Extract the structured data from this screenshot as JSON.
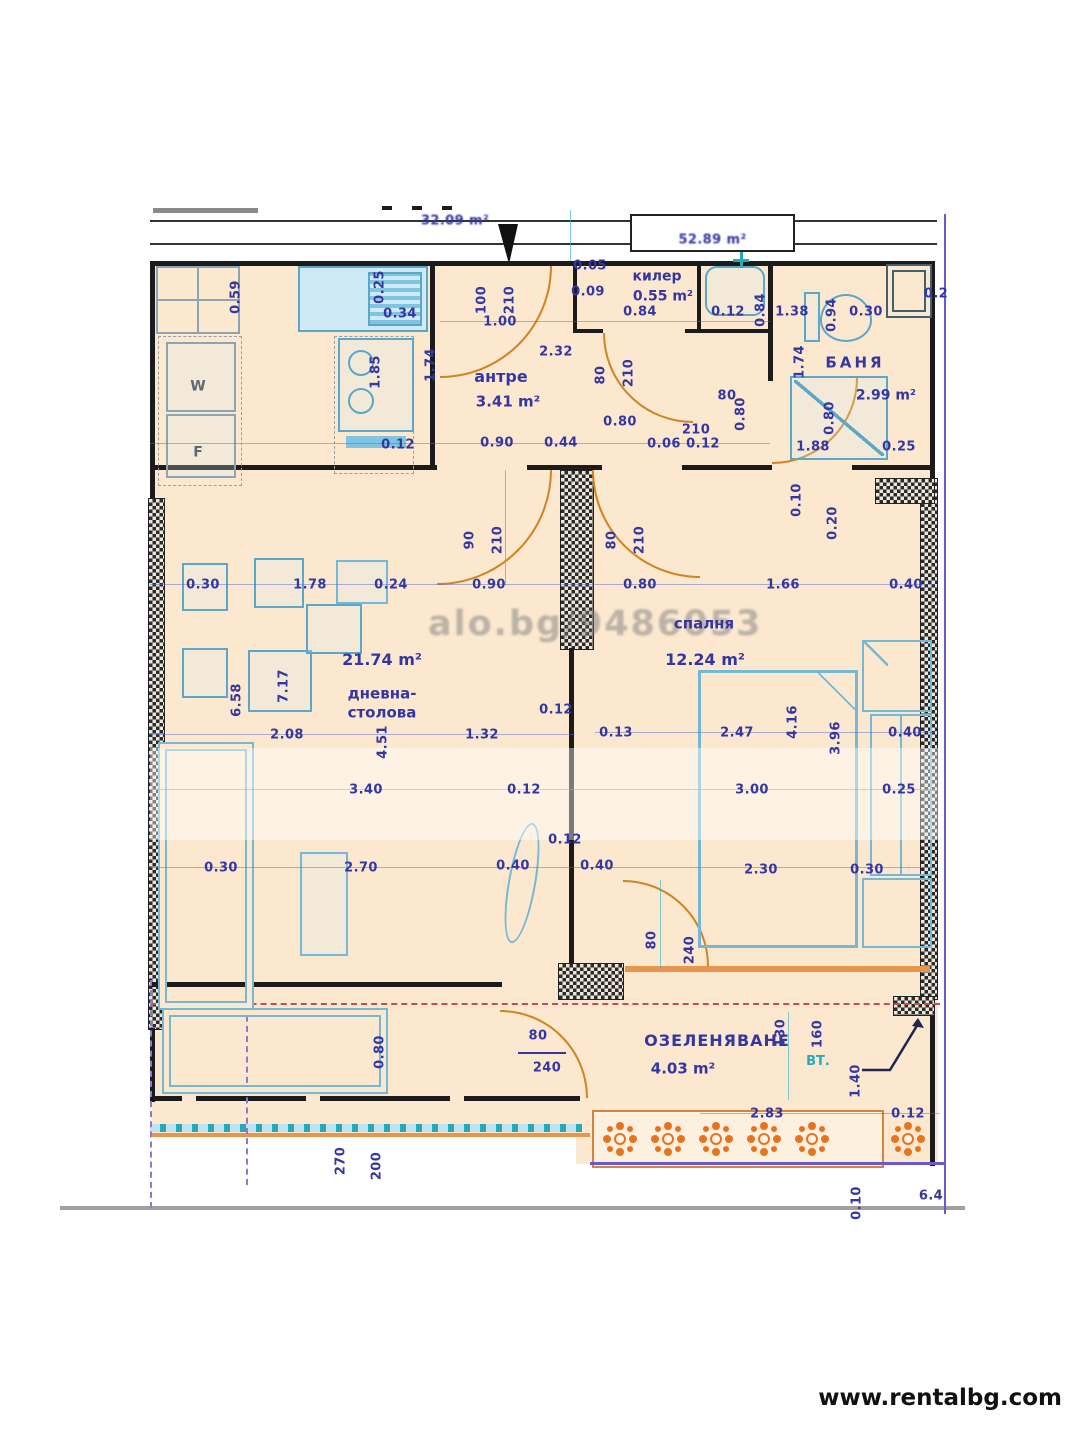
{
  "site": {
    "url": "www.rentalbg.com"
  },
  "watermarks": {
    "photo_id": "alo.bg/9486053"
  },
  "header": {
    "left_area": "32.09 m²",
    "box_area": "52.89 m²"
  },
  "rooms": [
    {
      "name": "антре",
      "area": "3.41 m²",
      "name_pos": [
        501,
        377
      ],
      "area_pos": [
        508,
        402
      ],
      "nfs": 16,
      "afs": 15
    },
    {
      "name": "килер",
      "area": "0.55 m²",
      "name_pos": [
        657,
        277
      ],
      "area_pos": [
        663,
        297
      ],
      "nfs": 14,
      "afs": 14
    },
    {
      "name": "БАНЯ",
      "area": "2.99 m²",
      "name_pos": [
        855,
        363
      ],
      "area_pos": [
        886,
        396
      ],
      "nfs": 15,
      "afs": 14,
      "ls": 3
    },
    {
      "name": "дневна-\nстолова",
      "area": "21.74 m²",
      "name_pos": [
        382,
        703
      ],
      "area_pos": [
        382,
        660
      ],
      "nfs": 15,
      "afs": 16
    },
    {
      "name": "спалня",
      "area": "12.24 m²",
      "name_pos": [
        704,
        624
      ],
      "area_pos": [
        705,
        660
      ],
      "nfs": 15,
      "afs": 16
    },
    {
      "name": "ОЗЕЛЕНЯВАНЕ",
      "area": "4.03 m²",
      "name_pos": [
        717,
        1041
      ],
      "area_pos": [
        683,
        1069
      ],
      "nfs": 16,
      "afs": 15,
      "ls": 1
    }
  ],
  "markers": [
    {
      "text": "ВТ.",
      "pos": [
        818,
        1062
      ],
      "color": "#2aa8b8",
      "fs": 13
    },
    {
      "text": "W",
      "pos": [
        198,
        387
      ],
      "color": "#5a6b75",
      "fs": 14
    },
    {
      "text": "F",
      "pos": [
        198,
        453
      ],
      "color": "#5a6b75",
      "fs": 14
    }
  ],
  "dims": [
    {
      "t": "0.59",
      "p": [
        236,
        297
      ],
      "v": 1
    },
    {
      "t": "0.25",
      "p": [
        380,
        287
      ],
      "v": 1
    },
    {
      "t": "0.34",
      "p": [
        400,
        314
      ]
    },
    {
      "t": "1.85",
      "p": [
        376,
        372
      ],
      "v": 1
    },
    {
      "t": "1.74",
      "p": [
        431,
        365
      ],
      "v": 1
    },
    {
      "t": "0.12",
      "p": [
        398,
        445
      ]
    },
    {
      "t": "100",
      "p": [
        482,
        300
      ],
      "v": 1
    },
    {
      "t": "210",
      "p": [
        510,
        300
      ],
      "v": 1
    },
    {
      "t": "1.00",
      "p": [
        500,
        322
      ]
    },
    {
      "t": "2.32",
      "p": [
        556,
        352
      ]
    },
    {
      "t": "0.05",
      "p": [
        590,
        266
      ]
    },
    {
      "t": "0.09",
      "p": [
        588,
        292
      ]
    },
    {
      "t": "0.84",
      "p": [
        640,
        312
      ]
    },
    {
      "t": "0.12",
      "p": [
        728,
        312
      ]
    },
    {
      "t": "0.84",
      "p": [
        761,
        310
      ],
      "v": 1
    },
    {
      "t": "1.38",
      "p": [
        792,
        312
      ]
    },
    {
      "t": "0.94",
      "p": [
        832,
        315
      ],
      "v": 1
    },
    {
      "t": "0.30",
      "p": [
        866,
        312
      ]
    },
    {
      "t": "0.2",
      "p": [
        936,
        294
      ]
    },
    {
      "t": "80",
      "p": [
        601,
        375
      ],
      "v": 1
    },
    {
      "t": "210",
      "p": [
        629,
        373
      ],
      "v": 1
    },
    {
      "t": "1.74",
      "p": [
        800,
        362
      ],
      "v": 1
    },
    {
      "t": "0.80",
      "p": [
        620,
        422
      ]
    },
    {
      "t": "80",
      "p": [
        727,
        396
      ]
    },
    {
      "t": "210",
      "p": [
        696,
        430
      ]
    },
    {
      "t": "0.80",
      "p": [
        741,
        414
      ],
      "v": 1
    },
    {
      "t": "0.90",
      "p": [
        497,
        443
      ]
    },
    {
      "t": "0.44",
      "p": [
        561,
        443
      ]
    },
    {
      "t": "0.06",
      "p": [
        664,
        444
      ]
    },
    {
      "t": "0.12",
      "p": [
        703,
        444
      ]
    },
    {
      "t": "1.88",
      "p": [
        813,
        447
      ]
    },
    {
      "t": "0.25",
      "p": [
        899,
        447
      ]
    },
    {
      "t": "0.80",
      "p": [
        830,
        418
      ],
      "v": 1
    },
    {
      "t": "0.10",
      "p": [
        797,
        500
      ],
      "v": 1
    },
    {
      "t": "0.20",
      "p": [
        833,
        523
      ],
      "v": 1
    },
    {
      "t": "90",
      "p": [
        470,
        540
      ],
      "v": 1
    },
    {
      "t": "210",
      "p": [
        498,
        540
      ],
      "v": 1
    },
    {
      "t": "80",
      "p": [
        612,
        540
      ],
      "v": 1
    },
    {
      "t": "210",
      "p": [
        640,
        540
      ],
      "v": 1
    },
    {
      "t": "0.30",
      "p": [
        203,
        585
      ]
    },
    {
      "t": "1.78",
      "p": [
        310,
        585
      ]
    },
    {
      "t": "0.24",
      "p": [
        391,
        585
      ]
    },
    {
      "t": "0.90",
      "p": [
        489,
        585
      ]
    },
    {
      "t": "0.80",
      "p": [
        640,
        585
      ]
    },
    {
      "t": "1.66",
      "p": [
        783,
        585
      ]
    },
    {
      "t": "0.40",
      "p": [
        906,
        585
      ]
    },
    {
      "t": "6.58",
      "p": [
        237,
        700
      ],
      "v": 1
    },
    {
      "t": "7.17",
      "p": [
        284,
        686
      ],
      "v": 1
    },
    {
      "t": "2.08",
      "p": [
        287,
        735
      ]
    },
    {
      "t": "4.51",
      "p": [
        383,
        742
      ],
      "v": 1
    },
    {
      "t": "1.32",
      "p": [
        482,
        735
      ]
    },
    {
      "t": "0.12",
      "p": [
        556,
        710
      ]
    },
    {
      "t": "3.40",
      "p": [
        366,
        790
      ]
    },
    {
      "t": "0.12",
      "p": [
        524,
        790
      ]
    },
    {
      "t": "0.12",
      "p": [
        565,
        840
      ]
    },
    {
      "t": "0.40",
      "p": [
        513,
        866
      ]
    },
    {
      "t": "0.40",
      "p": [
        597,
        866
      ]
    },
    {
      "t": "2.70",
      "p": [
        361,
        868
      ]
    },
    {
      "t": "0.30",
      "p": [
        221,
        868
      ]
    },
    {
      "t": "0.13",
      "p": [
        616,
        733
      ]
    },
    {
      "t": "2.47",
      "p": [
        737,
        733
      ]
    },
    {
      "t": "4.16",
      "p": [
        793,
        722
      ],
      "v": 1
    },
    {
      "t": "3.96",
      "p": [
        836,
        738
      ],
      "v": 1
    },
    {
      "t": "0.40",
      "p": [
        905,
        733
      ]
    },
    {
      "t": "3.00",
      "p": [
        752,
        790
      ]
    },
    {
      "t": "0.25",
      "p": [
        899,
        790
      ]
    },
    {
      "t": "2.30",
      "p": [
        761,
        870
      ]
    },
    {
      "t": "0.30",
      "p": [
        867,
        870
      ]
    },
    {
      "t": "80",
      "p": [
        652,
        940
      ],
      "v": 1
    },
    {
      "t": "240",
      "p": [
        690,
        950
      ],
      "v": 1
    },
    {
      "t": "0.80",
      "p": [
        380,
        1052
      ],
      "v": 1
    },
    {
      "t": "80",
      "p": [
        538,
        1036
      ]
    },
    {
      "t": "240",
      "p": [
        547,
        1068
      ]
    },
    {
      "t": "130",
      "p": [
        781,
        1033
      ],
      "v": 1
    },
    {
      "t": "160",
      "p": [
        818,
        1034
      ],
      "v": 1
    },
    {
      "t": "1.40",
      "p": [
        856,
        1081
      ],
      "v": 1
    },
    {
      "t": "2.83",
      "p": [
        767,
        1114
      ]
    },
    {
      "t": "0.12",
      "p": [
        908,
        1114
      ]
    },
    {
      "t": "270",
      "p": [
        341,
        1161
      ],
      "v": 1
    },
    {
      "t": "200",
      "p": [
        377,
        1166
      ],
      "v": 1
    },
    {
      "t": "0.10",
      "p": [
        857,
        1203
      ],
      "v": 1
    },
    {
      "t": "6.4",
      "p": [
        931,
        1196
      ]
    }
  ]
}
